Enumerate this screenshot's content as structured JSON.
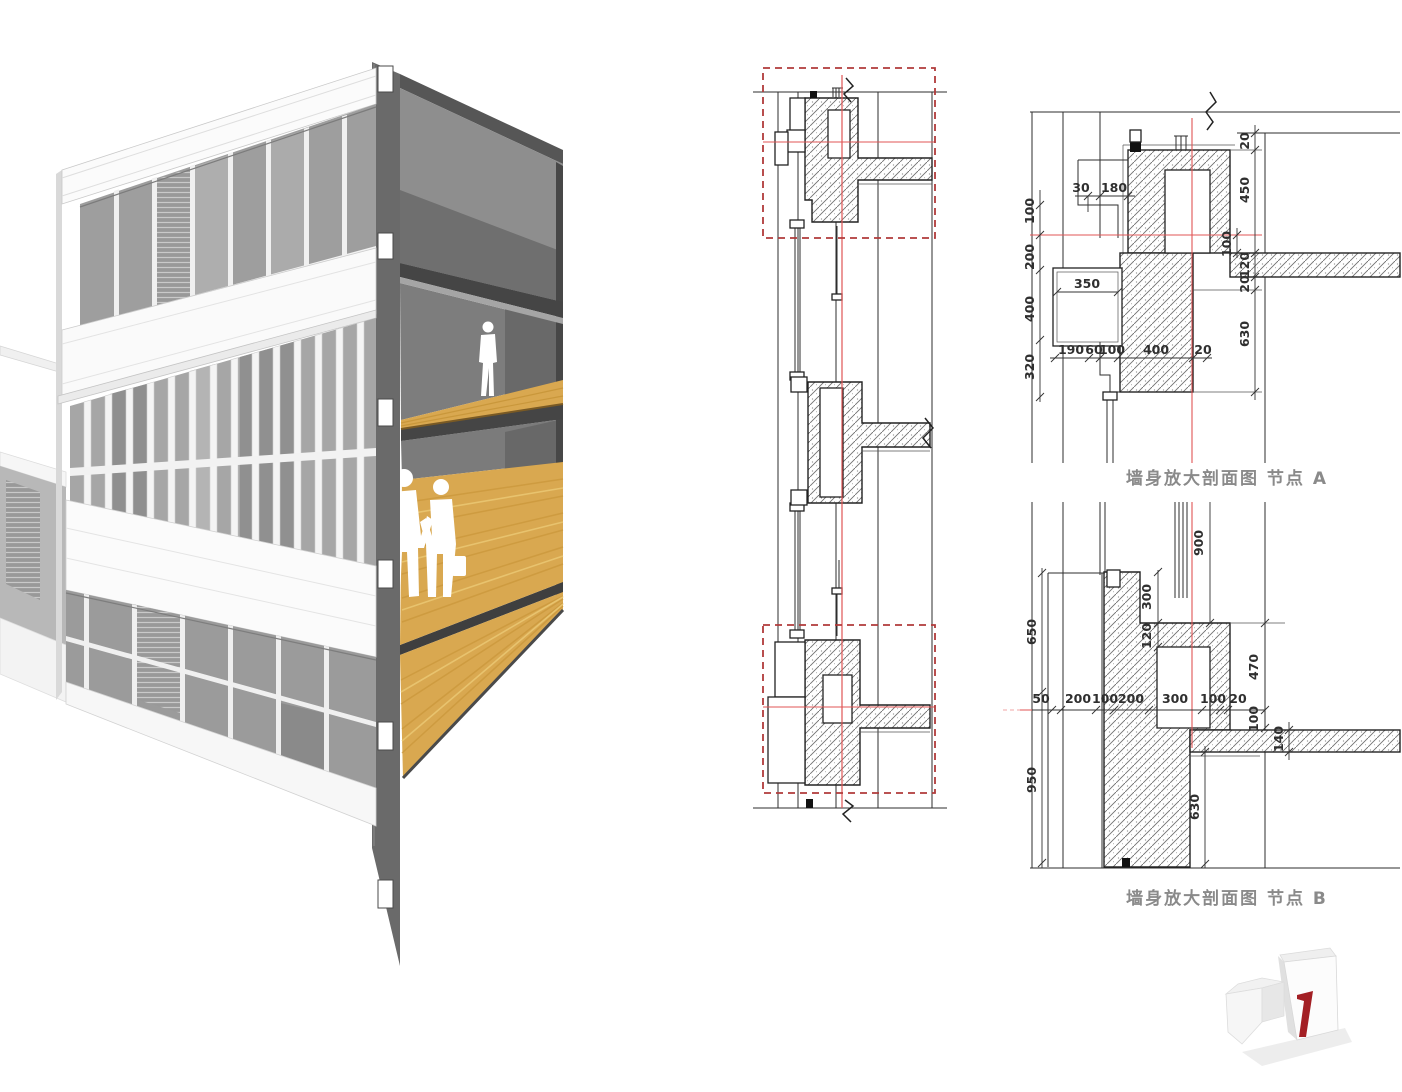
{
  "details": {
    "a": {
      "title": "墙身放大剖面图  节点 A",
      "dims": {
        "left": [
          "100",
          "200",
          "400",
          "320"
        ],
        "top": [
          "30",
          "180"
        ],
        "mid": [
          "350"
        ],
        "bottom": [
          "190",
          "60",
          "100",
          "400",
          "20"
        ],
        "right": [
          "20",
          "450",
          "120",
          "20",
          "630"
        ],
        "right_inner": [
          "100"
        ]
      }
    },
    "b": {
      "title": "墙身放大剖面图  节点 B",
      "dims": {
        "left": [
          "650",
          "950"
        ],
        "row": [
          "50",
          "200",
          "100",
          "200",
          "300",
          "100",
          "20"
        ],
        "mid_vertical": [
          "900",
          "300",
          "120"
        ],
        "right": [
          "470",
          "100",
          "140",
          "630"
        ]
      }
    }
  },
  "colors": {
    "crosshair_red": "#e05555",
    "detail_box_red": "#b03a3a",
    "wood": "#d9a850",
    "title_gray": "#8a8a8a",
    "logo_red": "#a31f24"
  },
  "logo": {
    "digit": "7"
  }
}
